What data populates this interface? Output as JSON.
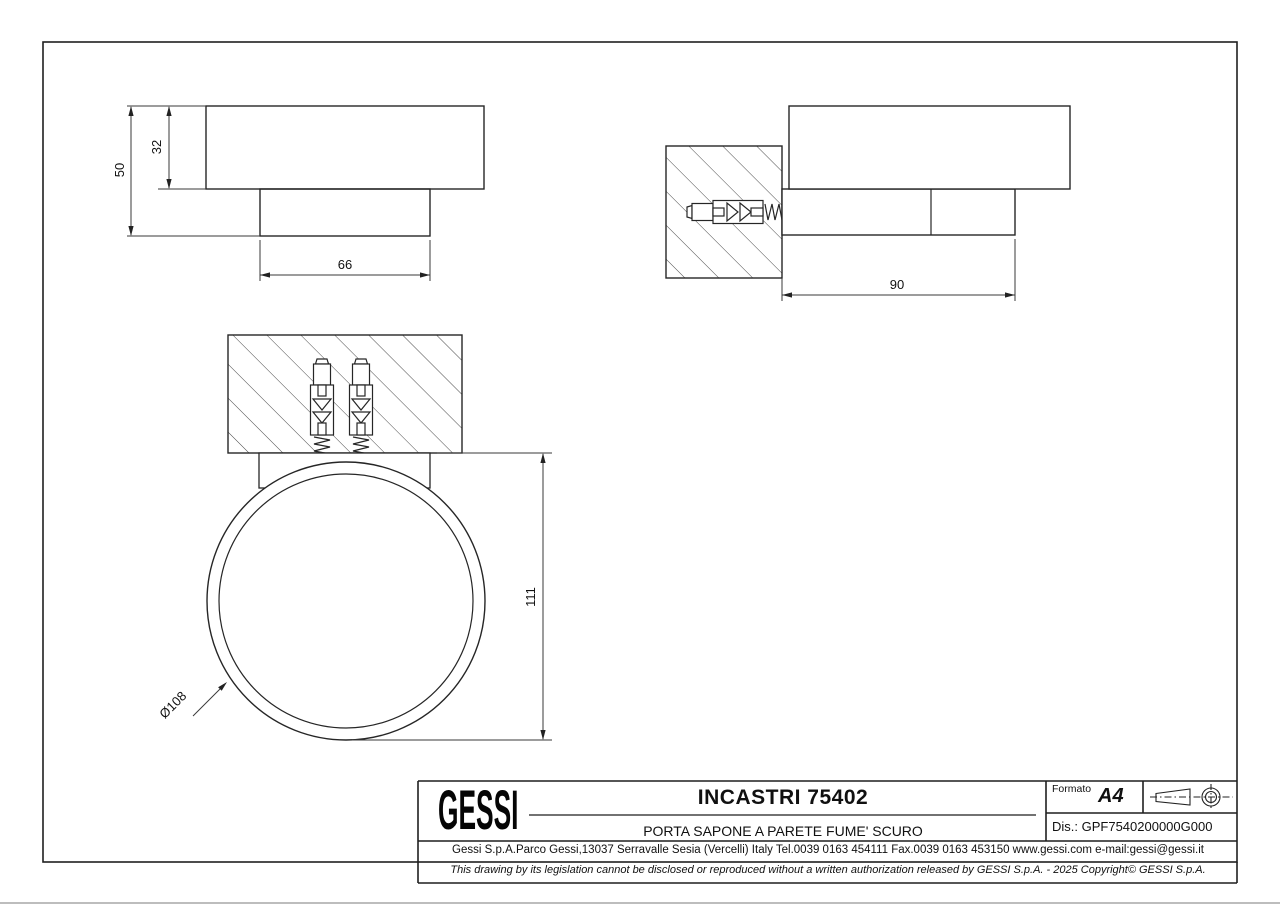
{
  "sheet": {
    "views": {
      "side_view": {
        "dims": {
          "height_total": "50",
          "height_body": "32",
          "width_base": "66"
        }
      },
      "section_view": {
        "dims": {
          "depth": "90"
        }
      },
      "front_view": {
        "dims": {
          "height": "111",
          "diameter": "Ø108"
        }
      }
    },
    "title_block": {
      "logo": "GESSI",
      "title": "INCASTRI 75402",
      "subtitle": "PORTA SAPONE A PARETE FUME' SCURO",
      "formato_label": "Formato",
      "formato_value": "A4",
      "drawing_number": "Dis.: GPF7540200000G000",
      "address": "Gessi S.p.A.Parco Gessi,13037 Serravalle Sesia (Vercelli) Italy Tel.0039 0163 454111 Fax.0039 0163 453150 www.gessi.com e-mail:gessi@gessi.it",
      "copyright": "This drawing by its legislation cannot be disclosed or reproduced without a written authorization released by GESSI S.p.A. - 2025 Copyright© GESSI S.p.A."
    },
    "colors": {
      "object_line": "#262626",
      "dim_line": "#3a3a3a",
      "hatch_line": "#4a4a4a",
      "border_line": "#1f1f1f",
      "page_edge": "#bdbdbd",
      "background": "#ffffff"
    }
  }
}
